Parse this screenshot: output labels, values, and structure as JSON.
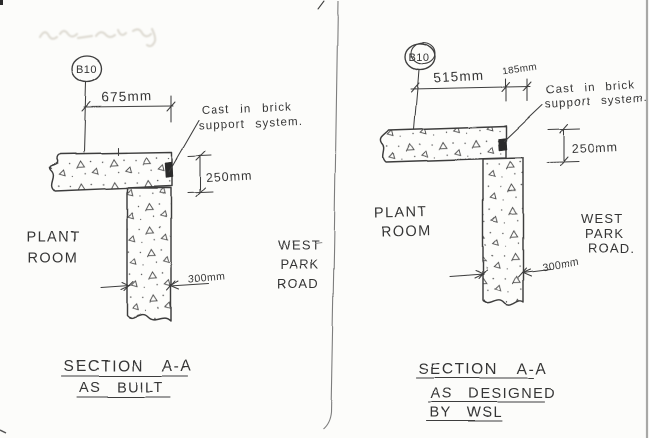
{
  "page": {
    "paper_color": "#fcfcfa",
    "ink_color": "#3e3e3e",
    "divider_color": "#7d7d7d"
  },
  "left_section": {
    "grid_bubble_label": "B10",
    "top_dimension": "675mm",
    "note_line1": "Cast in brick",
    "note_line2": "support system.",
    "slab_thickness_dimension": "250mm",
    "wall_thickness_dimension": "300mm",
    "room_label_line1": "PLANT",
    "room_label_line2": "ROOM",
    "road_label_line1": "WEST",
    "road_label_line2": "PARK",
    "road_label_line3": "ROAD",
    "title_line1": "SECTION A-A",
    "title_line2": "AS BUILT"
  },
  "right_section": {
    "grid_bubble_label": "B10",
    "top_dimension_main": "515mm",
    "top_dimension_edge": "185mm",
    "note_line1": "Cast in brick",
    "note_line2": "support system.",
    "slab_thickness_dimension": "250mm",
    "wall_thickness_dimension": "300mm",
    "room_label_line1": "PLANT",
    "room_label_line2": "ROOM",
    "road_label_line1": "WEST",
    "road_label_line2": "PARK",
    "road_label_line3": "ROAD.",
    "title_line1": "SECTION A-A",
    "title_line2": "AS DESIGNED",
    "title_line3": "BY WSL"
  }
}
